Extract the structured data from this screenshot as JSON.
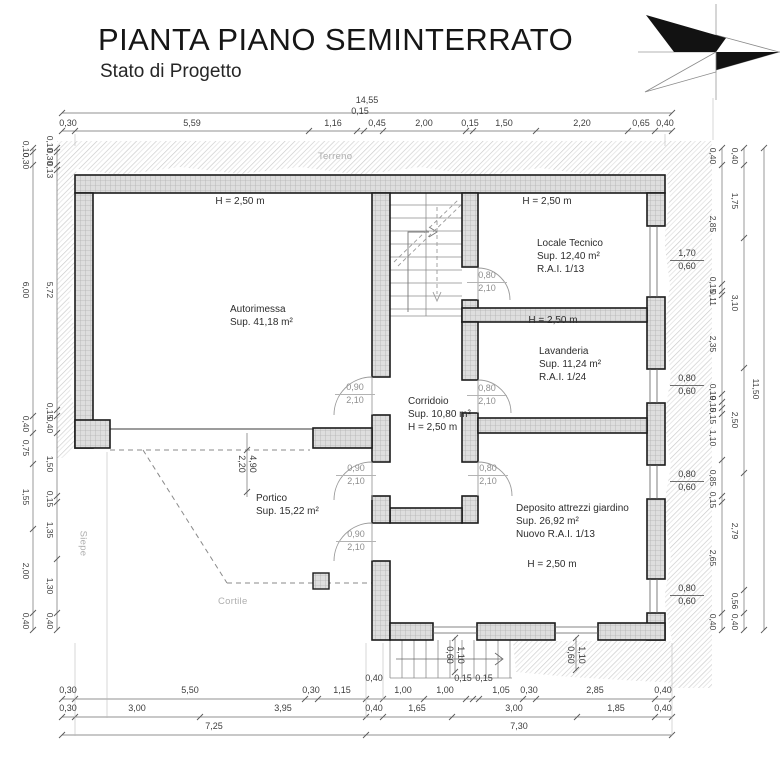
{
  "header": {
    "title": "PIANTA PIANO SEMINTERRATO",
    "subtitle": "Stato di Progetto"
  },
  "site": {
    "terreno": "Terreno",
    "cortile": "Cortile",
    "siepe": "Siepe"
  },
  "rooms": {
    "autorimessa": {
      "name": "Autorimessa",
      "area": "Sup. 41,18 m²",
      "height": "H = 2,50 m"
    },
    "locale_tecnico": {
      "name": "Locale Tecnico",
      "area": "Sup. 12,40 m²",
      "rai": "R.A.I. 1/13",
      "height": "H = 2,50 m"
    },
    "lavanderia": {
      "name": "Lavanderia",
      "area": "Sup. 11,24 m²",
      "rai": "R.A.I. 1/24",
      "height": "H = 2,50 m"
    },
    "corridoio": {
      "name": "Corridoio",
      "area": "Sup. 10,80 m²",
      "height": "H = 2,50 m"
    },
    "deposito": {
      "name": "Deposito attrezzi giardino",
      "area": "Sup. 26,92 m²",
      "rai": "Nuovo R.A.I. 1/13",
      "height": "H = 2,50 m"
    },
    "portico": {
      "name": "Portico",
      "area": "Sup. 15,22 m²"
    }
  },
  "doors": {
    "small": [
      "0,80",
      "2,10"
    ],
    "large": [
      "0,90",
      "2,10"
    ]
  },
  "windows": {
    "w_lt": [
      "1,70",
      "0,60"
    ],
    "w_std": [
      "0,80",
      "0,60"
    ],
    "w_bottom": [
      "1,10",
      "0,60"
    ]
  },
  "dims": {
    "top_total": "14,55",
    "top": [
      "0,30",
      "5,59",
      "1,16",
      "0,15",
      "0,45",
      "2,00",
      "0,15",
      "1,50",
      "2,20",
      "0,65",
      "0,40"
    ],
    "bottom1": [
      "0,30",
      "5,50",
      "0,30",
      "1,15",
      "0,40",
      "1,00",
      "1,00",
      "0,15",
      "0,15",
      "1,05",
      "0,30",
      "2,85",
      "0,40"
    ],
    "bottom2": [
      "0,30",
      "3,00",
      "3,95",
      "0,40",
      "1,65",
      "3,00",
      "1,85",
      "0,40"
    ],
    "bottom_totals": [
      "7,25",
      "7,30"
    ],
    "left_outer": [
      "0,10",
      "0,30",
      "6,00",
      "0,40",
      "0,75",
      "1,55",
      "2,00",
      "0,40"
    ],
    "left_inner": [
      "0,10",
      "0,30",
      "0,13",
      "5,72",
      "0,15",
      "0,40",
      "1,50",
      "0,15",
      "1,35",
      "1,30",
      "0,40"
    ],
    "right_inner": [
      "0,40",
      "2,85",
      "0,15",
      "0,11",
      "2,35",
      "0,19",
      "0,15",
      "0,15",
      "1,10",
      "0,85",
      "0,15",
      "2,65",
      "0,40"
    ],
    "right_mid": [
      "0,40",
      "1,75",
      "3,10",
      "2,50",
      "2,79",
      "0,56",
      "0,40"
    ],
    "right_total": "11,50",
    "portico": [
      "4,90",
      "2,20"
    ]
  }
}
